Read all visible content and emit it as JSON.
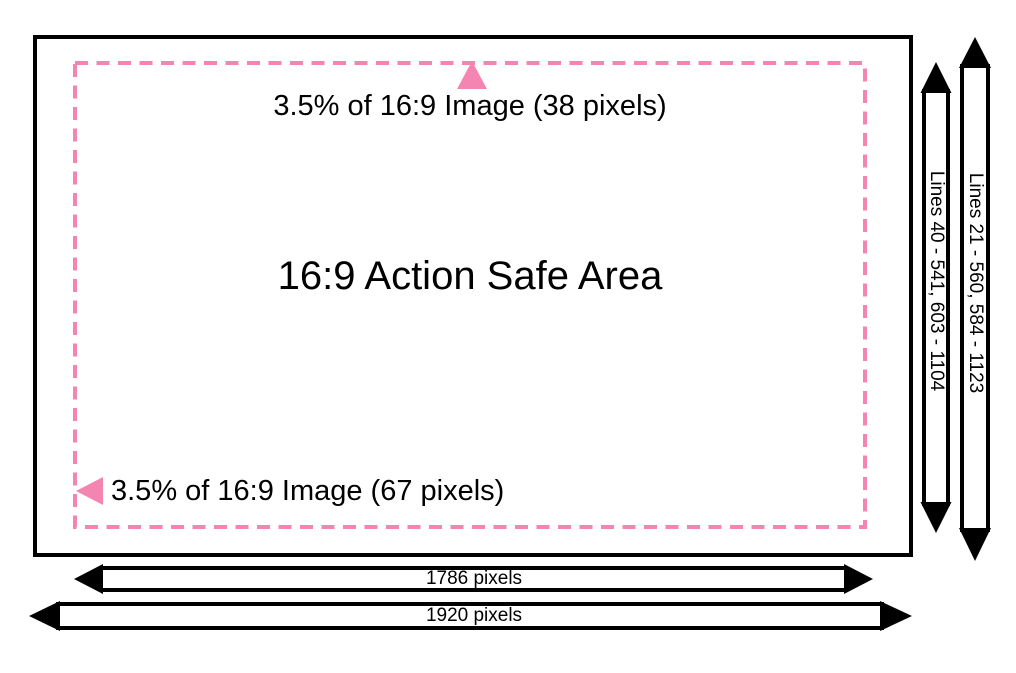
{
  "diagram": {
    "title": "16:9 Action Safe Area",
    "top_margin_label": "3.5% of 16:9 Image (38 pixels)",
    "side_margin_label": "3.5% of 16:9 Image (67 pixels)"
  },
  "dimensions": {
    "safe_height_lines": "Lines 40 - 541, 603 - 1104",
    "full_height_lines": "Lines 21 - 560, 584 - 1123",
    "safe_width": "1786 pixels",
    "full_width": "1920 pixels"
  },
  "colors": {
    "pink": "#F484B2",
    "black": "#000000",
    "background": "#FFFFFF"
  }
}
